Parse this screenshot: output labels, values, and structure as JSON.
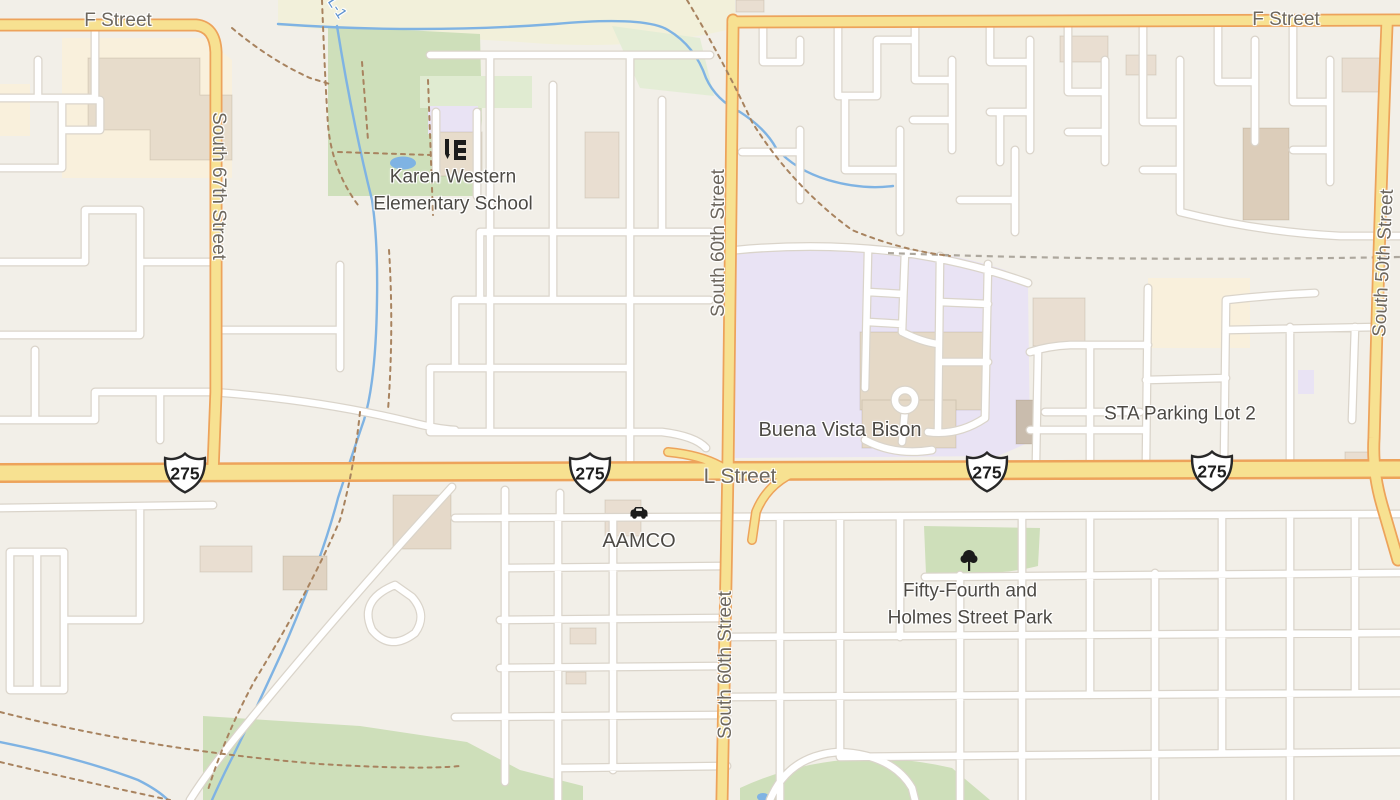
{
  "roads": {
    "f_street_left": "F Street",
    "f_street_right": "F Street",
    "south_67th": "South 67th Street",
    "south_60th_upper": "South 60th Street",
    "south_60th_lower": "South 60th Street",
    "south_50th": "South 50th Street",
    "l_street": "L Street"
  },
  "shields": [
    "275",
    "275",
    "275",
    "275"
  ],
  "pois": {
    "school_line1": "Karen Western",
    "school_line2": "Elementary School",
    "buena_vista": "Buena Vista Bison",
    "sta_parking": "STA Parking Lot 2",
    "aamco": "AAMCO",
    "park_line1": "Fifty-Fourth and",
    "park_line2": "Holmes Street Park",
    "waterway": "L-1"
  },
  "icons": {
    "school": "school-icon",
    "car": "car-icon",
    "tree": "tree-icon"
  },
  "colors": {
    "road_major_fill": "#F7E191",
    "road_major_casing": "#EDA35B",
    "water": "#7FB3E3",
    "park_green": "#CEDFBA",
    "campus_purple": "#E9E3F4",
    "commercial_yellow": "#F9F0DC",
    "trail_brown": "#A8835F",
    "label_street": "#6D675E",
    "label_poi": "#4D4A45"
  }
}
